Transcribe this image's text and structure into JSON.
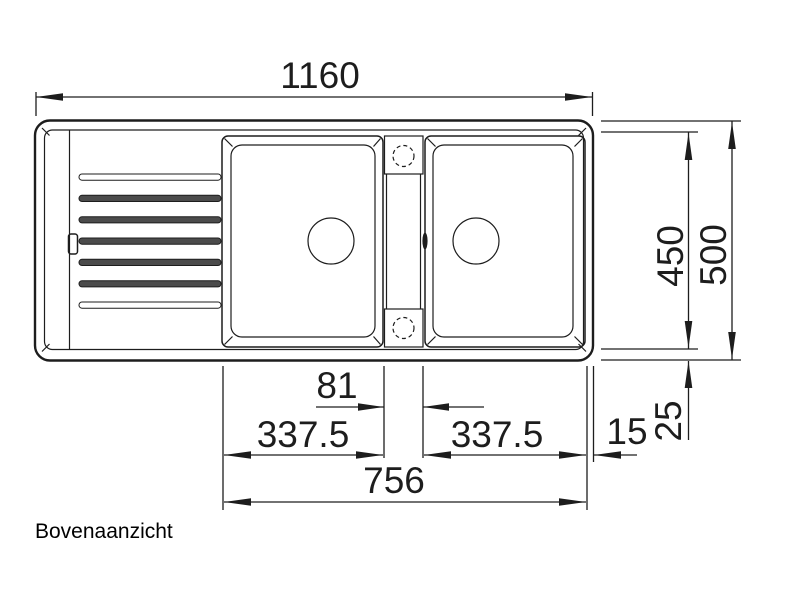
{
  "drawing": {
    "caption": "Bovenaanzicht",
    "dims": {
      "overall_width": "1160",
      "inner_depth": "450",
      "overall_depth": "500",
      "center_ledge_width": "81",
      "left_bowl_width": "337.5",
      "right_bowl_width": "337.5",
      "edge_gap": "15",
      "rim_gap": "25",
      "bowl_span": "756"
    }
  }
}
